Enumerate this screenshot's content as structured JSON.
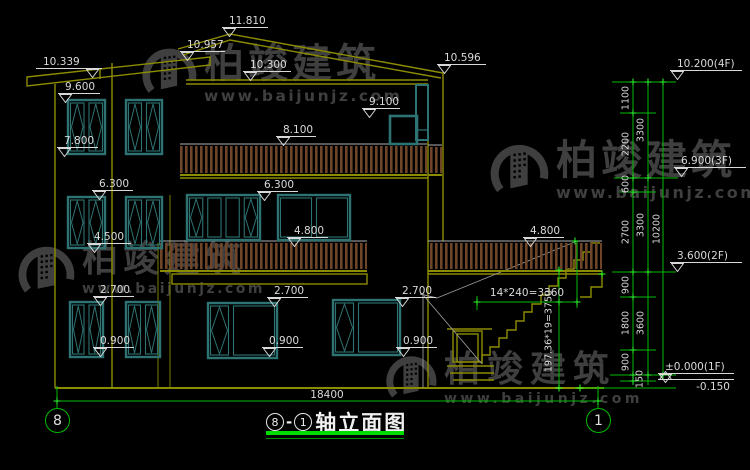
{
  "watermark": {
    "brand": "柏竣建筑",
    "site": "www.baijunjz.com"
  },
  "drawing": {
    "title": {
      "axis_from": "8",
      "separator": "-",
      "axis_to": "1",
      "name": "轴立面图"
    },
    "axis_bubbles": {
      "left": "8",
      "right": "1"
    },
    "elevation_marks": [
      {
        "label": "11.810",
        "x": 222,
        "y": 27,
        "w": 46,
        "tri": "left"
      },
      {
        "label": "10.957",
        "x": 180,
        "y": 51,
        "w": 45,
        "tri": "left"
      },
      {
        "label": "10.339",
        "x": 36,
        "y": 68,
        "w": 66,
        "tri": "right"
      },
      {
        "label": "10.300",
        "x": 243,
        "y": 71,
        "w": 48,
        "tri": "left"
      },
      {
        "label": "10.596",
        "x": 437,
        "y": 64,
        "w": 49,
        "tri": "left"
      },
      {
        "label": "9.600",
        "x": 58,
        "y": 93,
        "w": 42,
        "tri": "left"
      },
      {
        "label": "9.100",
        "x": 362,
        "y": 108,
        "w": 38,
        "tri": "left"
      },
      {
        "label": "8.100",
        "x": 276,
        "y": 136,
        "w": 40,
        "tri": "left"
      },
      {
        "label": "7.800",
        "x": 57,
        "y": 147,
        "w": 41,
        "tri": "left"
      },
      {
        "label": "6.300",
        "x": 92,
        "y": 190,
        "w": 41,
        "tri": "left"
      },
      {
        "label": "6.300",
        "x": 257,
        "y": 191,
        "w": 41,
        "tri": "left"
      },
      {
        "label": "4.800",
        "x": 287,
        "y": 237,
        "w": 41,
        "tri": "left"
      },
      {
        "label": "4.800",
        "x": 523,
        "y": 237,
        "w": 41,
        "tri": "left"
      },
      {
        "label": "4.500",
        "x": 87,
        "y": 243,
        "w": 44,
        "tri": "left"
      },
      {
        "label": "2.700",
        "x": 93,
        "y": 296,
        "w": 41,
        "tri": "left"
      },
      {
        "label": "2.700",
        "x": 267,
        "y": 297,
        "w": 41,
        "tri": "left"
      },
      {
        "label": "2.700",
        "x": 395,
        "y": 297,
        "w": 41,
        "tri": "left"
      },
      {
        "label": "0.900",
        "x": 93,
        "y": 347,
        "w": 41,
        "tri": "left"
      },
      {
        "label": "0.900",
        "x": 262,
        "y": 347,
        "w": 41,
        "tri": "left"
      },
      {
        "label": "0.900",
        "x": 396,
        "y": 347,
        "w": 41,
        "tri": "left"
      },
      {
        "label": "10.200(4F)",
        "x": 670,
        "y": 70,
        "w": 72,
        "tri": "left"
      },
      {
        "label": "6.900(3F)",
        "x": 674,
        "y": 167,
        "w": 72,
        "tri": "left"
      },
      {
        "label": "3.600(2F)",
        "x": 670,
        "y": 262,
        "w": 72,
        "tri": "left"
      },
      {
        "label": "±0.000(1F)",
        "x": 658,
        "y": 373,
        "w": 76,
        "tri": "left"
      },
      {
        "label": "-0.150",
        "x": 658,
        "y": 390,
        "w": 76,
        "tri": "up"
      }
    ],
    "dim_texts_vertical": [
      {
        "t": "1100",
        "x": 626,
        "y": 98
      },
      {
        "t": "2200",
        "x": 626,
        "y": 144
      },
      {
        "t": "600",
        "x": 626,
        "y": 184
      },
      {
        "t": "2700",
        "x": 626,
        "y": 232
      },
      {
        "t": "900",
        "x": 626,
        "y": 285
      },
      {
        "t": "1800",
        "x": 626,
        "y": 323
      },
      {
        "t": "900",
        "x": 626,
        "y": 362
      },
      {
        "t": "150",
        "x": 640,
        "y": 379
      },
      {
        "t": "3300",
        "x": 641,
        "y": 130
      },
      {
        "t": "3300",
        "x": 641,
        "y": 225
      },
      {
        "t": "3600",
        "x": 641,
        "y": 323
      },
      {
        "t": "10200",
        "x": 657,
        "y": 229
      },
      {
        "t": "197.36*19=3750",
        "x": 549,
        "y": 331
      }
    ],
    "dim_texts_horizontal": [
      {
        "t": "18400",
        "x": 327,
        "y": 389
      },
      {
        "t": "14*240=3360",
        "x": 527,
        "y": 287
      }
    ]
  },
  "colors": {
    "background": "#000000",
    "wall_line": "#8c8c00",
    "window_frame": "#2e7373",
    "railing": "#6e4529",
    "dimension_green": "#00bc00",
    "tick_green": "#2aff2a",
    "text": "#d9d9d9",
    "title_underline": "#00dc00",
    "watermark": "#3f3f3f"
  }
}
